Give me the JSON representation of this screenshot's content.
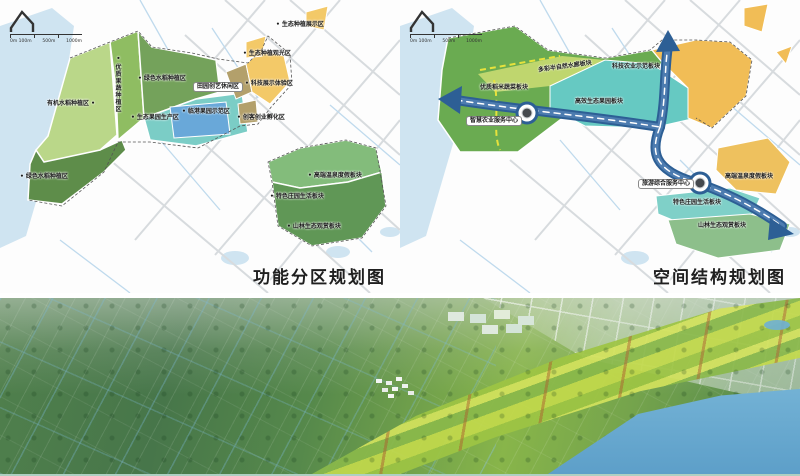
{
  "captions": {
    "left": "功能分区规划图",
    "right": "空间结构规划图"
  },
  "scale": {
    "s0": "0m 100m",
    "s1": "500m",
    "s2": "1000m"
  },
  "left_map": {
    "title": "功能分区规划图",
    "labels": [
      "• 生态种植展示区",
      "• 生态种植观光区",
      "• 绿色水稻种植区",
      "• 科技展示体验区",
      "田园创艺休闲区",
      "有机水稻种植区 •",
      "• 临港果园示范区",
      "• 生态果园生产区",
      "• 创客创业孵化区",
      "• 优质果蔬种植区",
      "• 绿色水稻种植区",
      "• 高端温泉度假板块",
      "• 特色庄园生活板块",
      "• 山林生态观赏板块"
    ]
  },
  "right_map": {
    "title": "空间结构规划图",
    "labels": [
      "科技农业示范板块",
      "多彩半自然水廊板块",
      "优质稻米蔬菜板块",
      "高效生态果园板块",
      "智慧农业服务中心",
      "旅游综合服务中心",
      "高端温泉度假板块",
      "特色庄园生活板块",
      "山林生态观赏板块"
    ]
  },
  "colors": {
    "water": "#cfe4f1",
    "road_gray": "#d7dbde",
    "canal_blue": "#bfdaed",
    "zone_light_green": "#bad789",
    "zone_dark_green": "#5e8d4a",
    "zone_teal": "#7bcdc6",
    "zone_blue": "#69a8d9",
    "zone_tan": "#b3a06b",
    "zone_yellow": "#f3c968",
    "zone_orange": "#eec15e",
    "corridor_blue": "#2d5f95",
    "dashed_yellow": "#e7e23c"
  }
}
